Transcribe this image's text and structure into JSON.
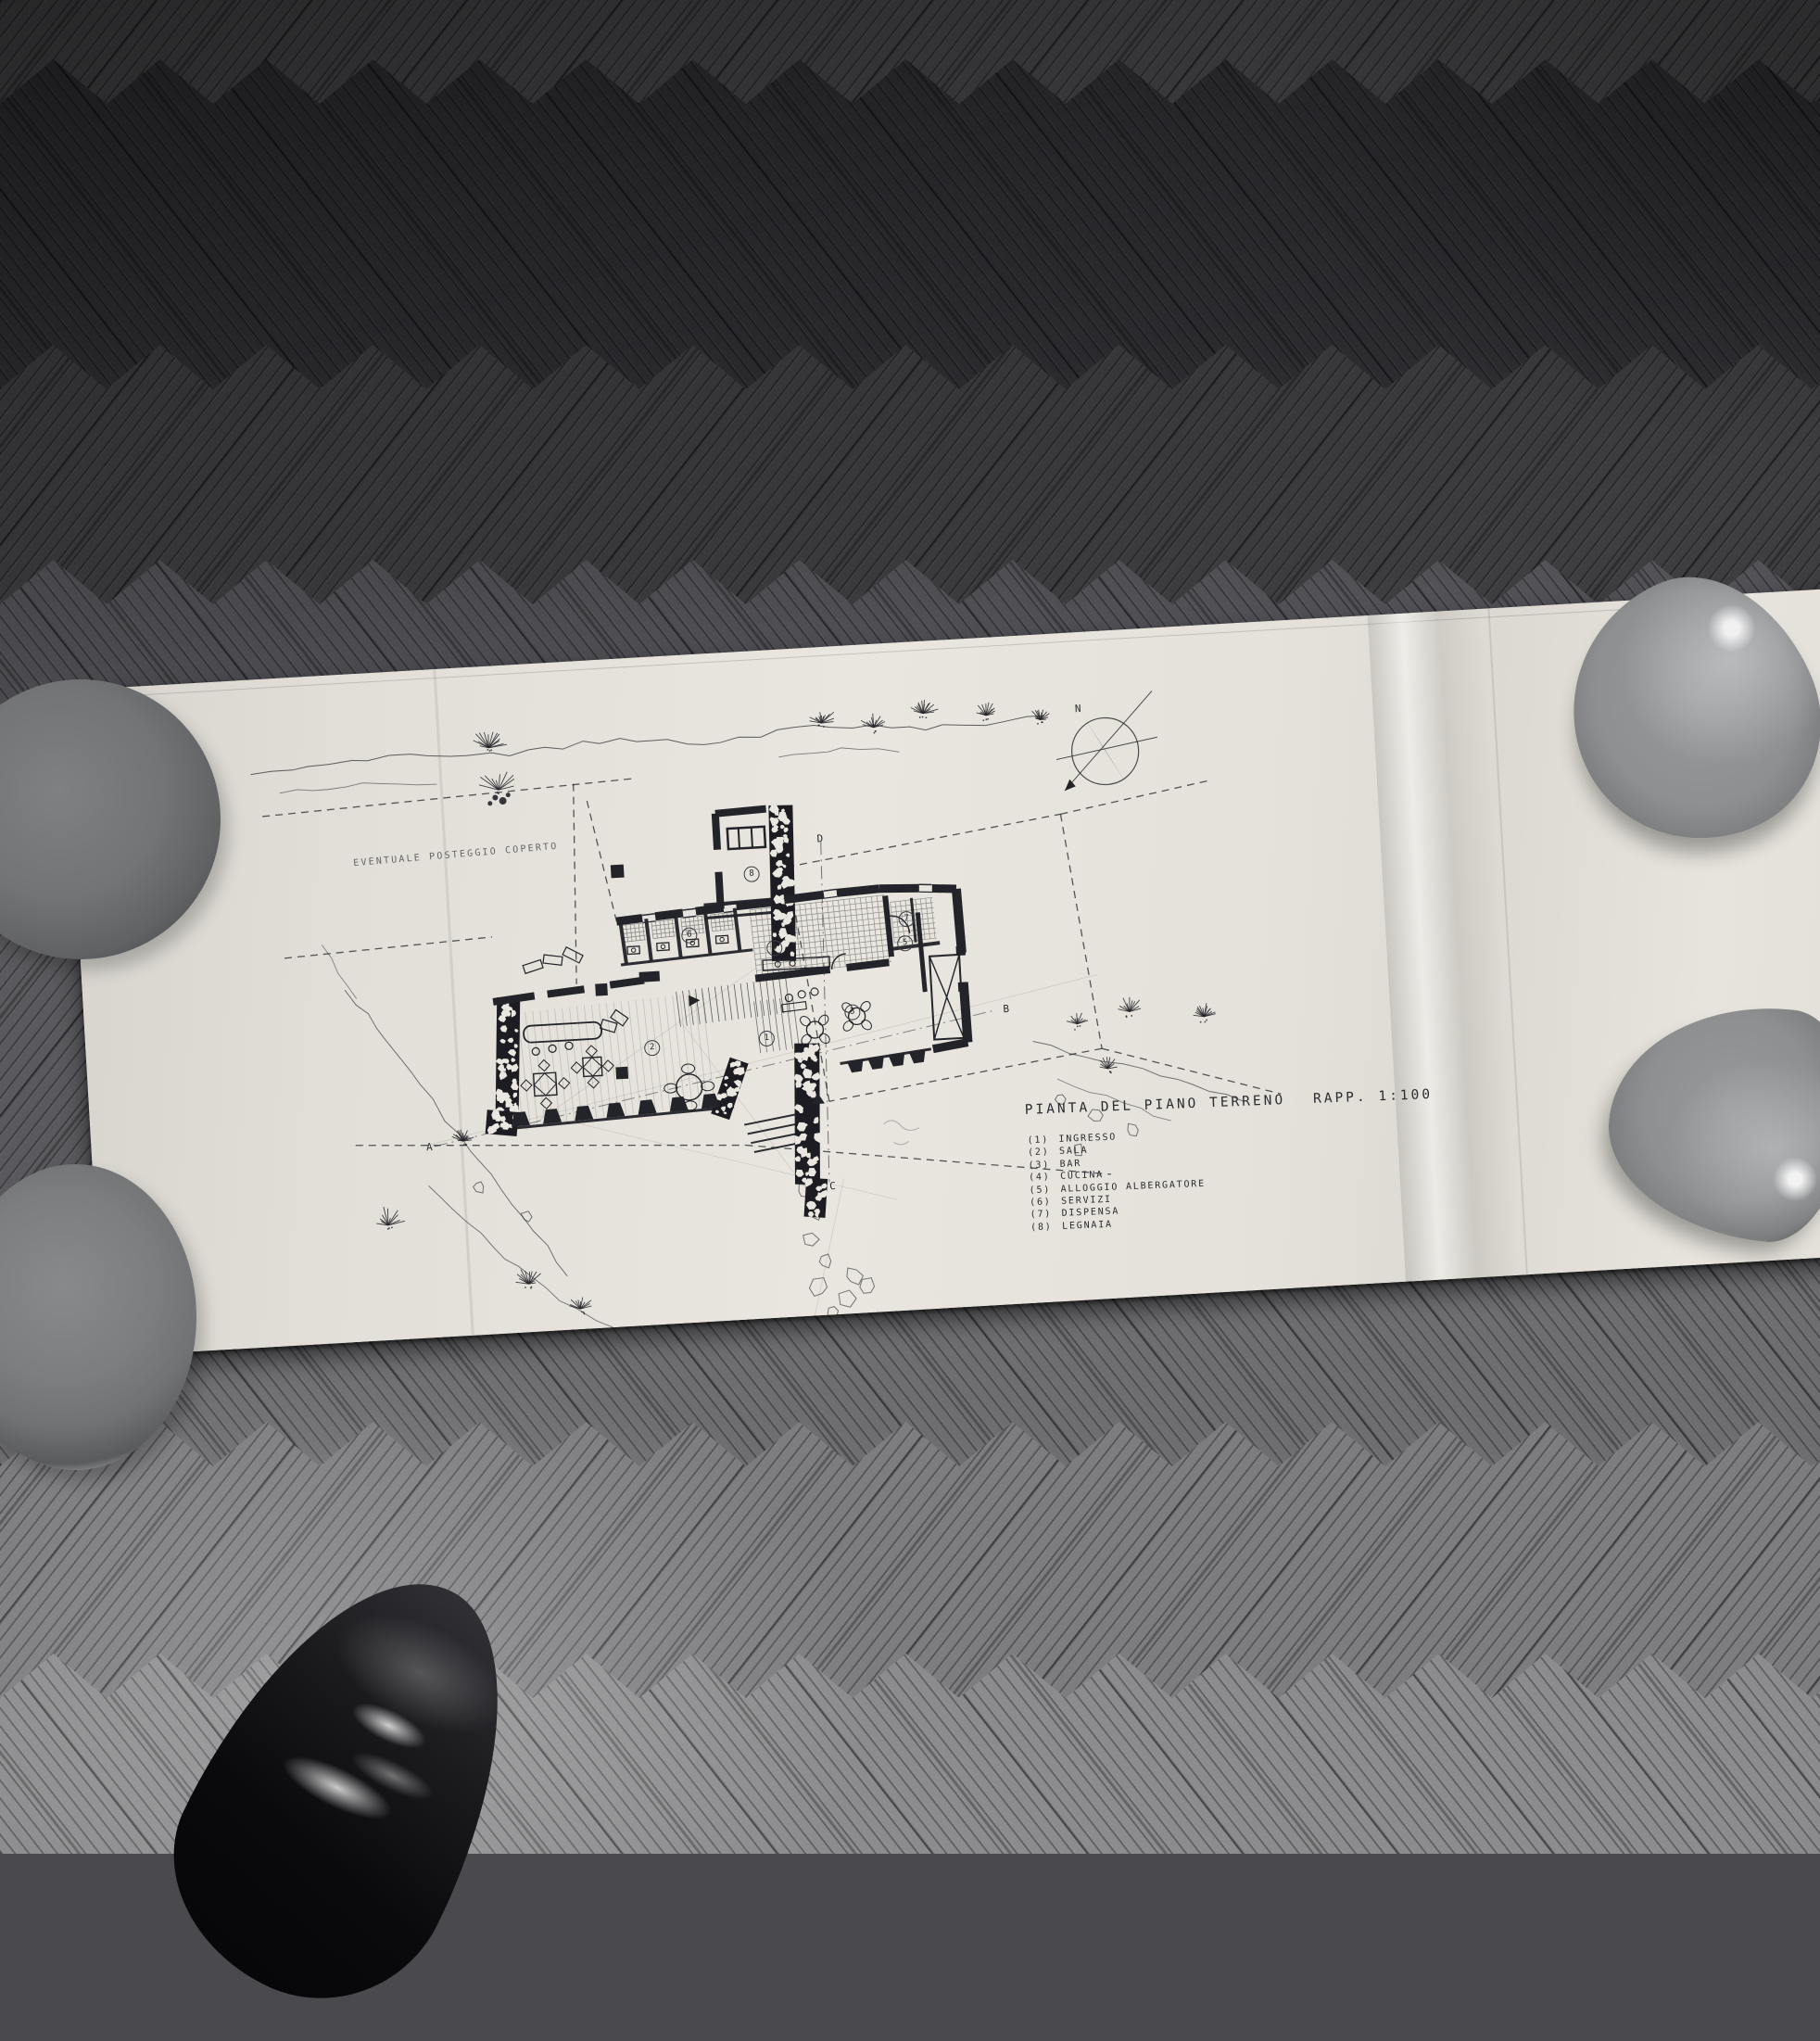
{
  "drawing": {
    "title": "PIANTA DEL PIANO TERRENO",
    "scale": "RAPP. 1:100",
    "annotation": "EVENTUALE POSTEGGIO COPERTO",
    "compass": "N",
    "rooms": [
      "1",
      "2",
      "3",
      "4",
      "5",
      "6",
      "7",
      "8"
    ],
    "sections": [
      "A",
      "B",
      "C",
      "D"
    ],
    "legend": {
      "items": [
        {
          "num": "(1)",
          "label": "INGRESSO"
        },
        {
          "num": "(2)",
          "label": "SALA"
        },
        {
          "num": "(3)",
          "label": "BAR"
        },
        {
          "num": "(4)",
          "label": "CUCINA"
        },
        {
          "num": "(5)",
          "label": "ALLOGGIO ALBERGATORE"
        },
        {
          "num": "(6)",
          "label": "SERVIZI"
        },
        {
          "num": "(7)",
          "label": "DISPENSA"
        },
        {
          "num": "(8)",
          "label": "LEGNAIA"
        }
      ]
    }
  },
  "colors": {
    "paper": "#e6e4dc",
    "ink": "#23232a",
    "floor_dark": "#303034",
    "floor_light": "#8c8c8e",
    "bowl_gray": "#8e9092"
  }
}
